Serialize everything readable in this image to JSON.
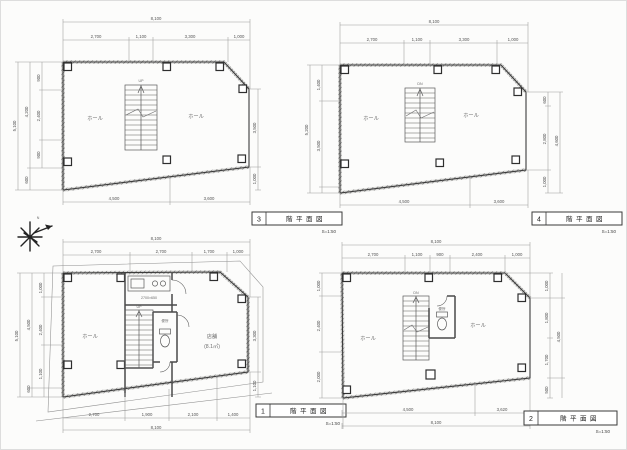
{
  "colors": {
    "paper": "#fcfcfb",
    "ink": "#3c3c3c",
    "dim_line": "#9b9b9b"
  },
  "north": {
    "label": "N"
  },
  "plans": {
    "p3": {
      "no": "3",
      "title": "階平面図",
      "scale": "S=1:50",
      "labels": [
        {
          "t": "8,100",
          "x": 156,
          "y": 20,
          "n": "dim-top-overall"
        },
        {
          "t": "2,700",
          "x": 96,
          "y": 38
        },
        {
          "t": "1,100",
          "x": 141,
          "y": 38
        },
        {
          "t": "3,300",
          "x": 190,
          "y": 38
        },
        {
          "t": "1,000",
          "x": 239,
          "y": 38
        },
        {
          "t": "5,100",
          "x": 16,
          "y": 126,
          "r": -90
        },
        {
          "t": "4,200",
          "x": 28,
          "y": 112,
          "r": -90
        },
        {
          "t": "600",
          "x": 28,
          "y": 180,
          "r": -90
        },
        {
          "t": "900",
          "x": 40,
          "y": 78,
          "r": -90
        },
        {
          "t": "2,400",
          "x": 40,
          "y": 116,
          "r": -90
        },
        {
          "t": "900",
          "x": 40,
          "y": 155,
          "r": -90
        },
        {
          "t": "3,500",
          "x": 256,
          "y": 128,
          "r": -90
        },
        {
          "t": "1,000",
          "x": 256,
          "y": 179,
          "r": -90
        },
        {
          "t": "4,500",
          "x": 114,
          "y": 200
        },
        {
          "t": "3,600",
          "x": 209,
          "y": 200
        },
        {
          "t": "ホール",
          "x": 95,
          "y": 120,
          "c": "rm",
          "n": "room-label"
        },
        {
          "t": "ホール",
          "x": 196,
          "y": 118,
          "c": "rm",
          "n": "room-label"
        },
        {
          "t": "UP",
          "x": 141,
          "y": 82,
          "c": "tny",
          "n": "stair-direction-label"
        }
      ]
    },
    "p4": {
      "no": "4",
      "title": "階平面図",
      "scale": "S=1:50",
      "labels": [
        {
          "t": "8,100",
          "x": 434,
          "y": 23,
          "n": "dim-top-overall"
        },
        {
          "t": "2,700",
          "x": 372,
          "y": 41
        },
        {
          "t": "1,100",
          "x": 417,
          "y": 41
        },
        {
          "t": "3,300",
          "x": 464,
          "y": 41
        },
        {
          "t": "1,000",
          "x": 513,
          "y": 41
        },
        {
          "t": "5,200",
          "x": 308,
          "y": 130,
          "r": -90
        },
        {
          "t": "1,400",
          "x": 320,
          "y": 85,
          "r": -90
        },
        {
          "t": "3,500",
          "x": 320,
          "y": 146,
          "r": -90
        },
        {
          "t": "600",
          "x": 546,
          "y": 100,
          "r": -90
        },
        {
          "t": "2,800",
          "x": 546,
          "y": 139,
          "r": -90
        },
        {
          "t": "1,000",
          "x": 546,
          "y": 182,
          "r": -90
        },
        {
          "t": "4,600",
          "x": 558,
          "y": 141,
          "r": -90
        },
        {
          "t": "4,500",
          "x": 404,
          "y": 203
        },
        {
          "t": "3,600",
          "x": 499,
          "y": 203
        },
        {
          "t": "ホール",
          "x": 371,
          "y": 120,
          "c": "rm",
          "n": "room-label"
        },
        {
          "t": "ホール",
          "x": 471,
          "y": 117,
          "c": "rm",
          "n": "room-label"
        },
        {
          "t": "DN",
          "x": 420,
          "y": 85,
          "c": "tny",
          "n": "stair-direction-label"
        }
      ]
    },
    "p1": {
      "no": "1",
      "title": "階平面図",
      "scale": "S=1:50",
      "labels": [
        {
          "t": "8,100",
          "x": 156,
          "y": 240,
          "n": "dim-top-overall"
        },
        {
          "t": "2,700",
          "x": 96,
          "y": 253
        },
        {
          "t": "2,700",
          "x": 161,
          "y": 253
        },
        {
          "t": "1,700",
          "x": 209,
          "y": 253
        },
        {
          "t": "1,000",
          "x": 238,
          "y": 253
        },
        {
          "t": "5,100",
          "x": 18,
          "y": 336,
          "r": -90
        },
        {
          "t": "4,500",
          "x": 30,
          "y": 325,
          "r": -90
        },
        {
          "t": "600",
          "x": 30,
          "y": 389,
          "r": -90
        },
        {
          "t": "1,000",
          "x": 42,
          "y": 288,
          "r": -90
        },
        {
          "t": "2,400",
          "x": 42,
          "y": 330,
          "r": -90
        },
        {
          "t": "1,100",
          "x": 42,
          "y": 374,
          "r": -90
        },
        {
          "t": "3,300",
          "x": 256,
          "y": 336,
          "r": -90
        },
        {
          "t": "1,100",
          "x": 256,
          "y": 386,
          "r": -90
        },
        {
          "t": "2,700",
          "x": 94,
          "y": 416
        },
        {
          "t": "1,900",
          "x": 147,
          "y": 416
        },
        {
          "t": "2,100",
          "x": 193,
          "y": 416
        },
        {
          "t": "1,400",
          "x": 233,
          "y": 416
        },
        {
          "t": "8,100",
          "x": 156,
          "y": 429,
          "n": "dim-bottom-overall"
        },
        {
          "t": "ホール",
          "x": 90,
          "y": 338,
          "c": "rm",
          "n": "room-label"
        },
        {
          "t": "店舗",
          "x": 212,
          "y": 338,
          "c": "rm",
          "n": "room-label"
        },
        {
          "t": "(8.1㎡)",
          "x": 212,
          "y": 348,
          "c": "rm",
          "n": "room-area-label"
        },
        {
          "t": "2700×650",
          "x": 149,
          "y": 299,
          "c": "tny",
          "n": "kitchen-counter-note"
        },
        {
          "t": "便所",
          "x": 165,
          "y": 322,
          "c": "tny",
          "n": "wc-label"
        },
        {
          "t": "UP",
          "x": 139,
          "y": 308,
          "c": "tny",
          "n": "stair-direction-label"
        }
      ]
    },
    "p2": {
      "no": "2",
      "title": "階平面図",
      "scale": "S=1:50",
      "labels": [
        {
          "t": "8,100",
          "x": 436,
          "y": 243,
          "n": "dim-top-overall"
        },
        {
          "t": "2,700",
          "x": 373,
          "y": 256
        },
        {
          "t": "1,100",
          "x": 417,
          "y": 256
        },
        {
          "t": "900",
          "x": 440,
          "y": 256
        },
        {
          "t": "2,400",
          "x": 477,
          "y": 256
        },
        {
          "t": "1,000",
          "x": 517,
          "y": 256
        },
        {
          "t": "1,000",
          "x": 320,
          "y": 286,
          "r": -90
        },
        {
          "t": "2,400",
          "x": 320,
          "y": 326,
          "r": -90
        },
        {
          "t": "2,000",
          "x": 320,
          "y": 377,
          "r": -90
        },
        {
          "t": "1,000",
          "x": 548,
          "y": 286,
          "r": -90
        },
        {
          "t": "1,800",
          "x": 548,
          "y": 318,
          "r": -90
        },
        {
          "t": "1,700",
          "x": 548,
          "y": 360,
          "r": -90
        },
        {
          "t": "500",
          "x": 548,
          "y": 390,
          "r": -90
        },
        {
          "t": "4,500",
          "x": 560,
          "y": 337,
          "r": -90
        },
        {
          "t": "4,500",
          "x": 408,
          "y": 411
        },
        {
          "t": "3,620",
          "x": 502,
          "y": 411
        },
        {
          "t": "8,100",
          "x": 436,
          "y": 424,
          "n": "dim-bottom-overall"
        },
        {
          "t": "ホール",
          "x": 368,
          "y": 340,
          "c": "rm",
          "n": "room-label"
        },
        {
          "t": "ホール",
          "x": 478,
          "y": 327,
          "c": "rm",
          "n": "room-label"
        },
        {
          "t": "便所",
          "x": 442,
          "y": 310,
          "c": "tny",
          "n": "wc-label"
        },
        {
          "t": "DN",
          "x": 416,
          "y": 294,
          "c": "tny",
          "n": "stair-direction-label"
        }
      ]
    }
  }
}
